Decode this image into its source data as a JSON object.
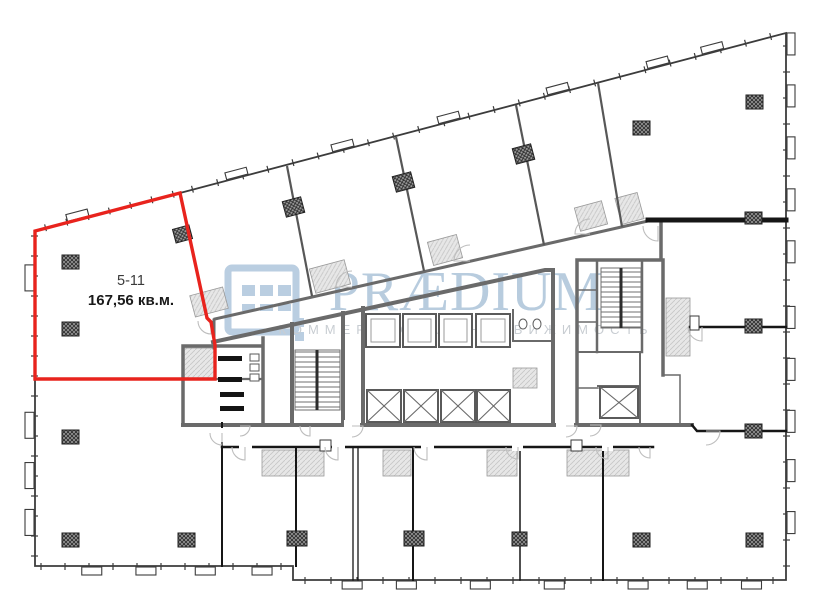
{
  "plan": {
    "title": "floor-plan",
    "unit": {
      "id": "5-11",
      "area": "167,56 кв.м."
    },
    "watermark": {
      "brand": "PRÆDIUM",
      "tagline": "КОММЕРЧЕСКАЯ НЕДВИЖИМОСТЬ"
    },
    "colors": {
      "unit_highlight": "#e8231d",
      "watermark_brand": "#b5cadd",
      "watermark_tagline": "#c6cbd0",
      "wall_gray": "#6a6a6a",
      "wall_dark": "#1a1a1a",
      "unit_label_color": "#3a3a3a"
    }
  }
}
